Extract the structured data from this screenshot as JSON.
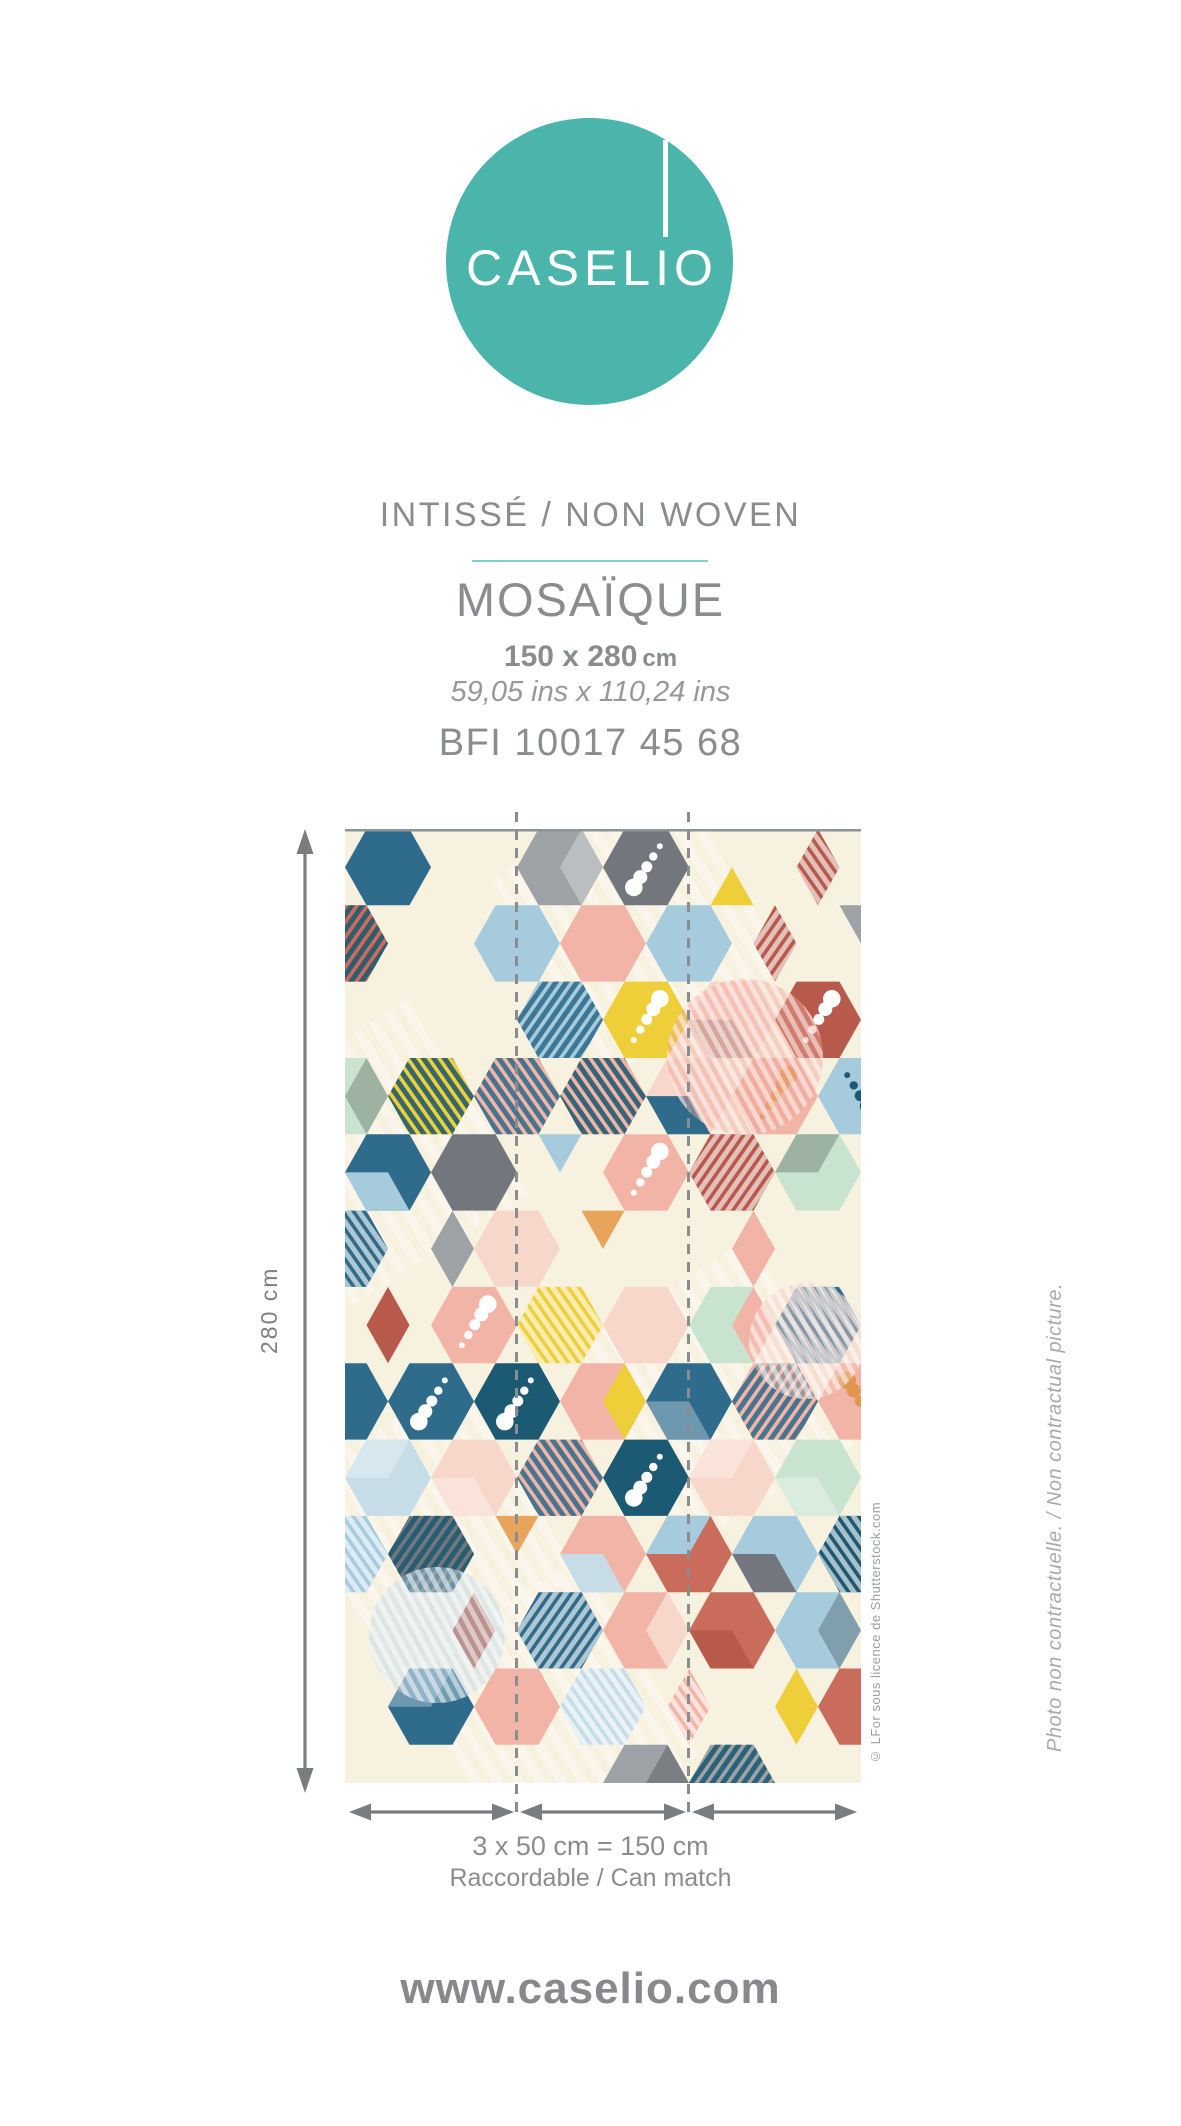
{
  "logo": {
    "brand": "CASELIO",
    "circle_color": "#4BB5AB"
  },
  "product": {
    "material": "INTISSÉ / NON WOVEN",
    "name": "MOSAÏQUE",
    "size_cm": "150 x 280",
    "size_unit": "cm",
    "size_ins": "59,05 ins x 110,24 ins",
    "reference": "BFI 10017 45 68"
  },
  "figure": {
    "height_label": "280 cm",
    "width_label": "3 x 50 cm = 150 cm",
    "match_label": "Raccordable / Can match",
    "credit": "© LFor sous licence de Shutterstock.com",
    "disclaimer": "Photo non contractuelle. / Non contractual picture.",
    "panels": 3
  },
  "footer": {
    "website": "www.caselio.com"
  },
  "theme": {
    "accent_teal": "#4BB5AB",
    "divider_teal": "#7FD2C8",
    "text_gray": "#8A8D90",
    "arrow_gray": "#7A7D80",
    "dash_gray": "#8A8D90"
  },
  "mosaic": {
    "seed": 5,
    "background": "#F7F1DF",
    "accent": "#E8A45B",
    "palette": [
      {
        "c": "#F2B4A6",
        "w": 13
      },
      {
        "c": "#F8D7CB",
        "w": 11
      },
      {
        "c": "#A6CBDC",
        "w": 11
      },
      {
        "c": "#C6DDE7",
        "w": 5
      },
      {
        "c": "#2F6C8C",
        "w": 10
      },
      {
        "c": "#1B5A72",
        "w": 5
      },
      {
        "c": "#C9E4CE",
        "w": 9
      },
      {
        "c": "#9EA2A7",
        "w": 8
      },
      {
        "c": "#73777D",
        "w": 5
      },
      {
        "c": "#B85A4B",
        "w": 7
      },
      {
        "c": "#C96C5C",
        "w": 4
      },
      {
        "c": "#EFCF39",
        "w": 9
      }
    ],
    "stripe_colors": [
      {
        "c": "#FFFFFF",
        "w": 10
      },
      {
        "c": "#1B5A72",
        "w": 3
      },
      {
        "c": "#2F6C8C",
        "w": 2
      },
      {
        "c": "#B85A4B",
        "w": 1
      }
    ],
    "dot_colors": [
      {
        "c": "#FFFFFF",
        "w": 6
      },
      {
        "c": "#E0964F",
        "w": 2
      },
      {
        "c": "#A4433A",
        "w": 2
      },
      {
        "c": "#1B5A72",
        "w": 1
      }
    ]
  }
}
